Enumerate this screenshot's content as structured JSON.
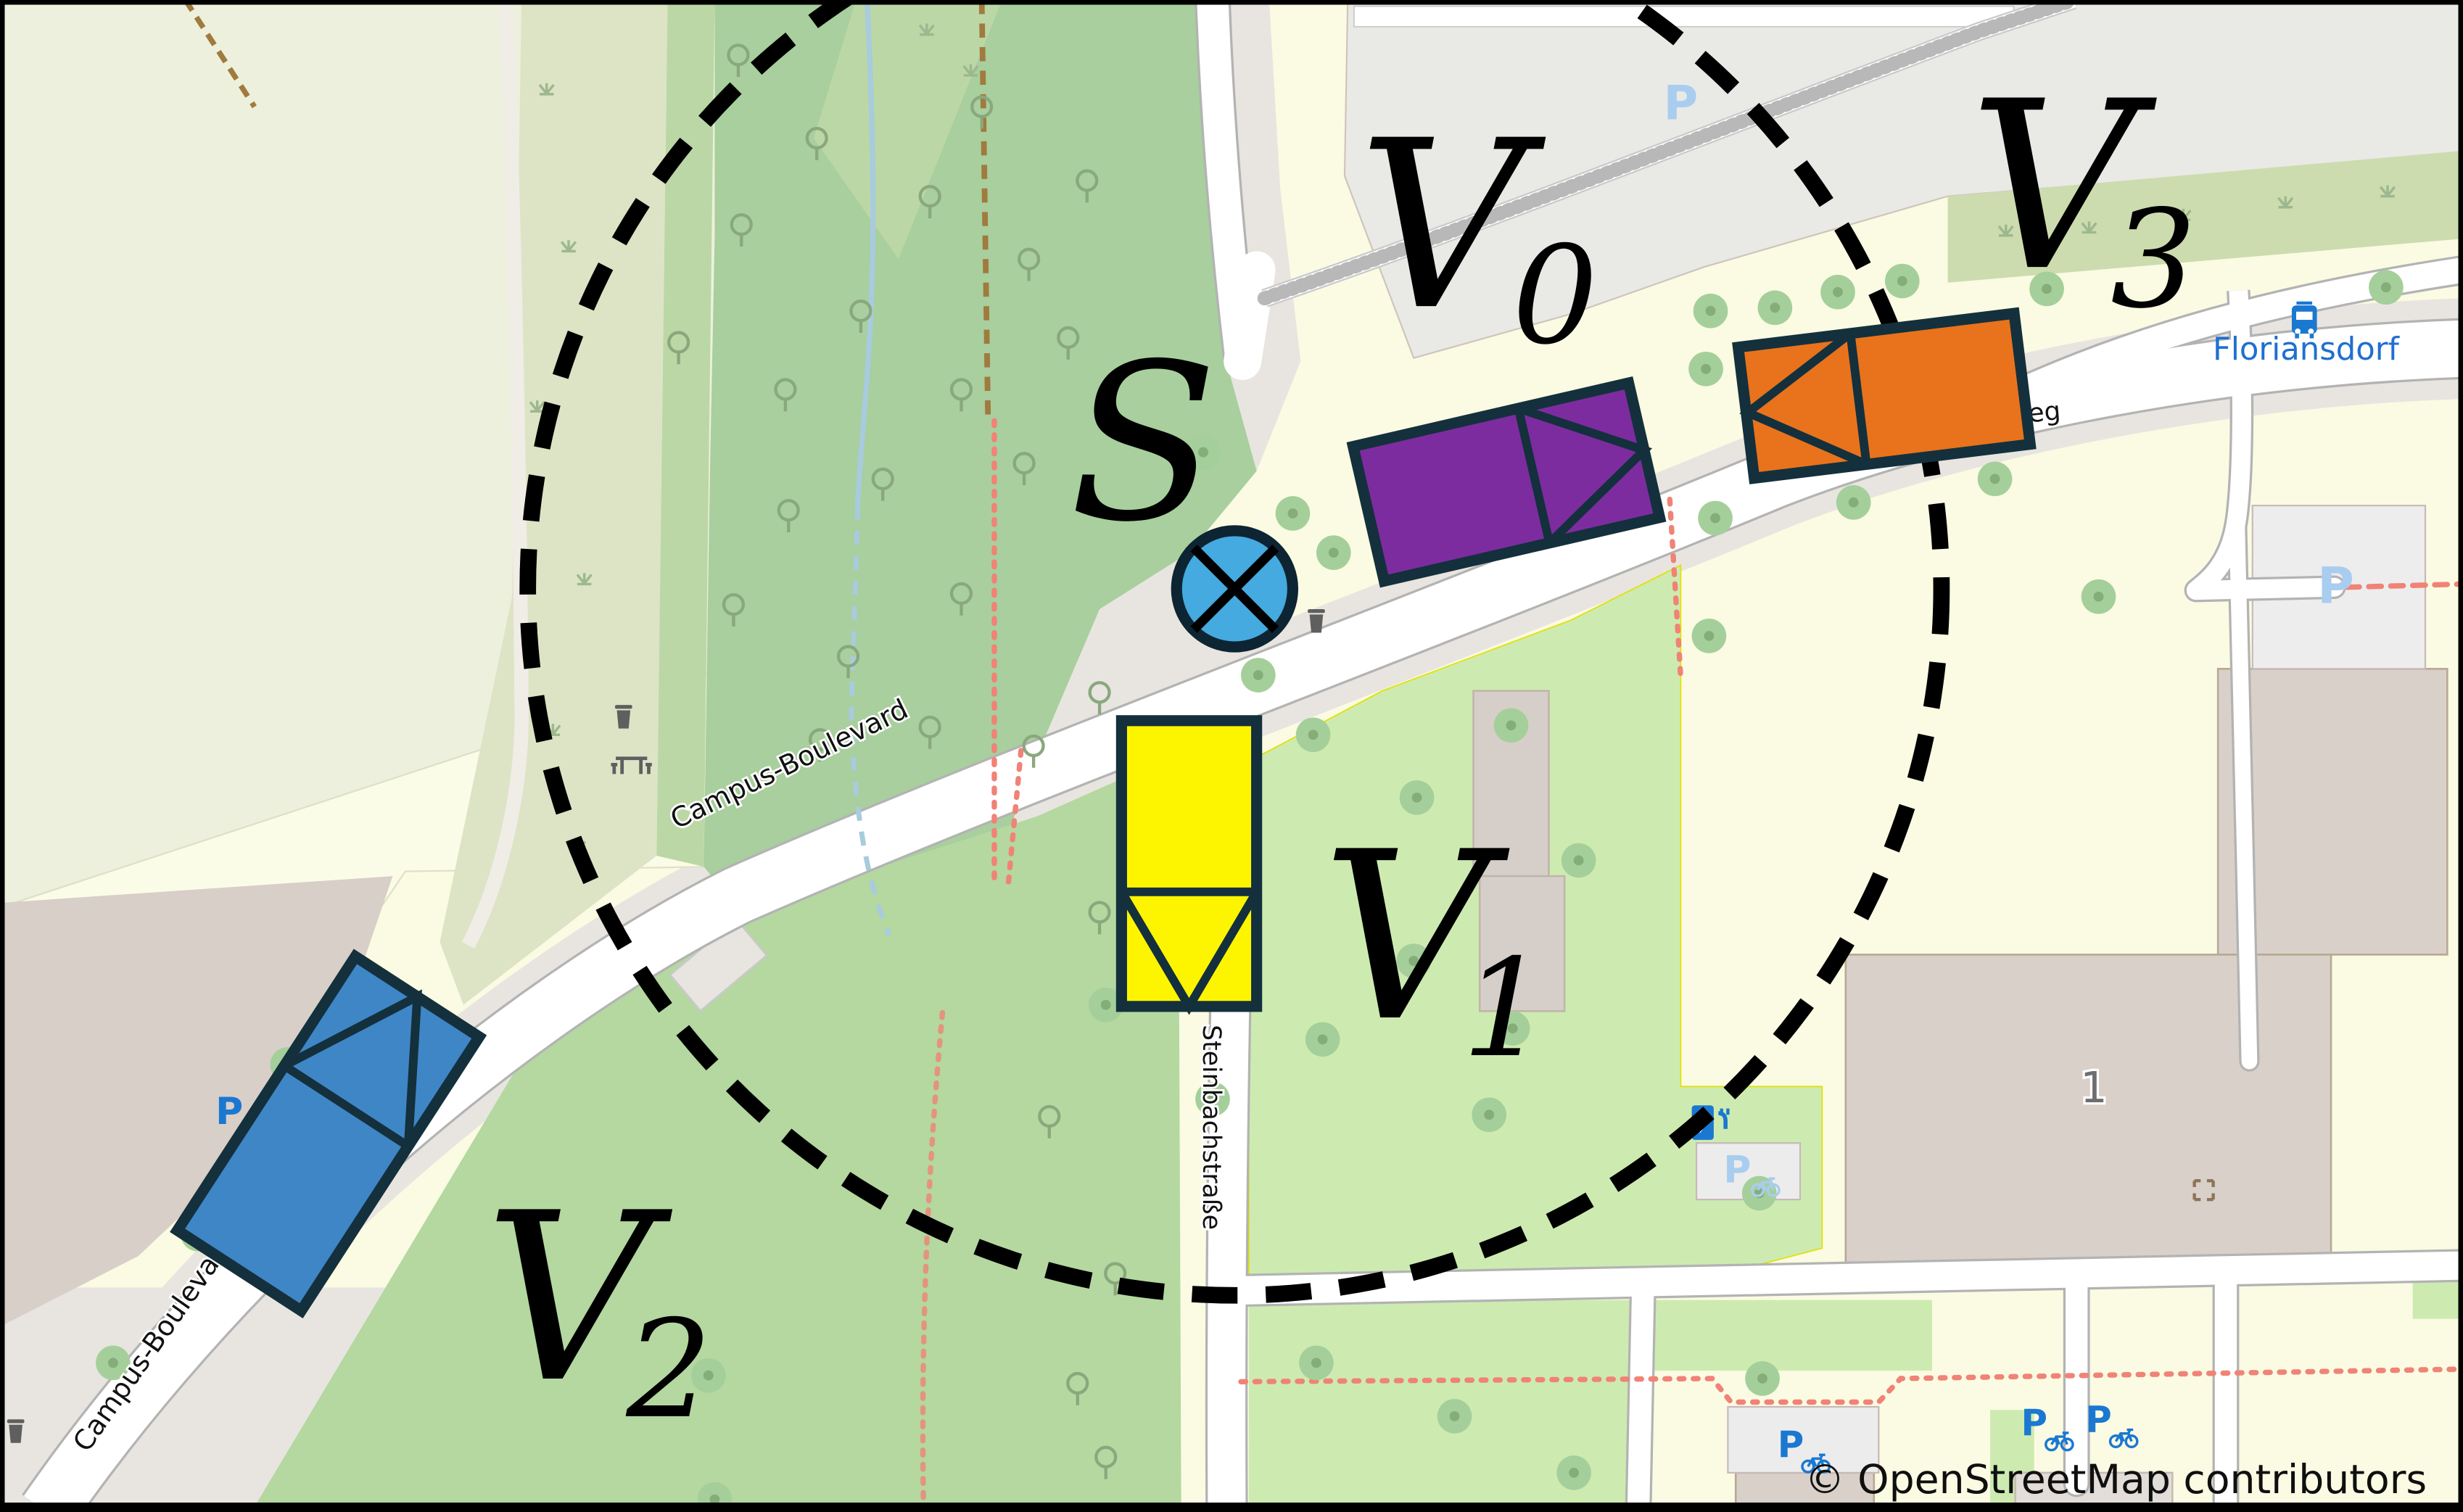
{
  "map": {
    "attribution": "© OpenStreetMap contributors",
    "streets": {
      "campus_boulevard": "Campus-Boulevard",
      "steinbachstrasse": "Steinbachstraße",
      "weg_partial": "eg"
    },
    "places": {
      "floriansdorf": "Floriansdorf",
      "house_number": "1"
    },
    "icons": {
      "parking_letter": "P"
    },
    "colors": {
      "forest": "#a8cf9d",
      "grass": "#cdebb0",
      "farmland": "#edf0dc",
      "residential_grey": "#e9e9e6",
      "plaza_grey": "#e8e5e0",
      "building": "#d9d0c9",
      "water": "#a8cbdd",
      "footpath_red": "#f08376",
      "footpath_brown": "#a07a3e",
      "poi_blue": "#1b78d1",
      "poi_pale_blue": "#a9cdef"
    }
  },
  "markers": {
    "sensor": {
      "label": "S",
      "color": "#45aadf"
    },
    "range_circle": {
      "color": "#000000",
      "style": "dashed"
    },
    "vehicles": [
      {
        "id": "V0",
        "label_main": "V",
        "label_sub": "0",
        "color": "#7d2ca0",
        "heading": "east"
      },
      {
        "id": "V1",
        "label_main": "V",
        "label_sub": "1",
        "color": "#fdf500",
        "heading": "south"
      },
      {
        "id": "V2",
        "label_main": "V",
        "label_sub": "2",
        "color": "#3f86c7",
        "heading": "northeast"
      },
      {
        "id": "V3",
        "label_main": "V",
        "label_sub": "3",
        "color": "#e8731c",
        "heading": "west"
      }
    ]
  }
}
